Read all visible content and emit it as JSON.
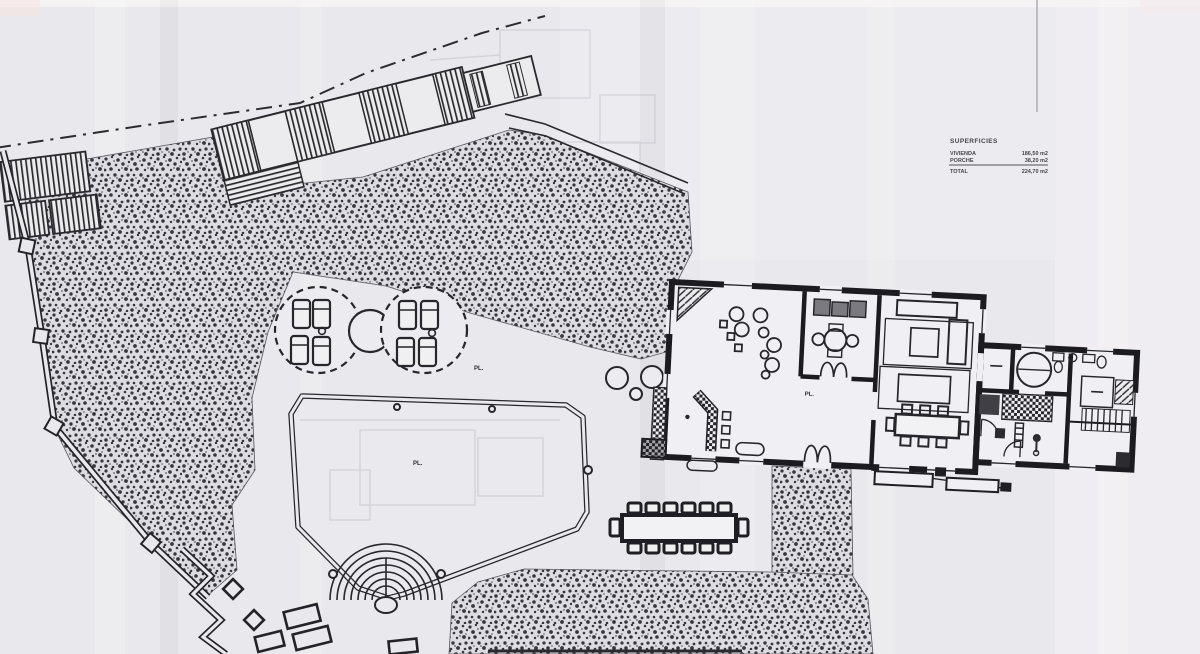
{
  "doc": {
    "kind": "scanned architectural site plan with pool and house floor plan",
    "legend": {
      "title": "SUPERFICIES",
      "rows": [
        {
          "label": "VIVIENDA",
          "value": "186,50 m2"
        },
        {
          "label": "PORCHE",
          "value": "38,20 m2"
        }
      ],
      "total_label": "TOTAL",
      "total_value": "224,70 m2"
    },
    "labels": {
      "pool": "PL.",
      "terrace": "PL.",
      "room": "PL."
    },
    "colors": {
      "paper": "#e9e8ec",
      "ink": "#26262b",
      "stipple_bg": "#dddce1"
    }
  }
}
